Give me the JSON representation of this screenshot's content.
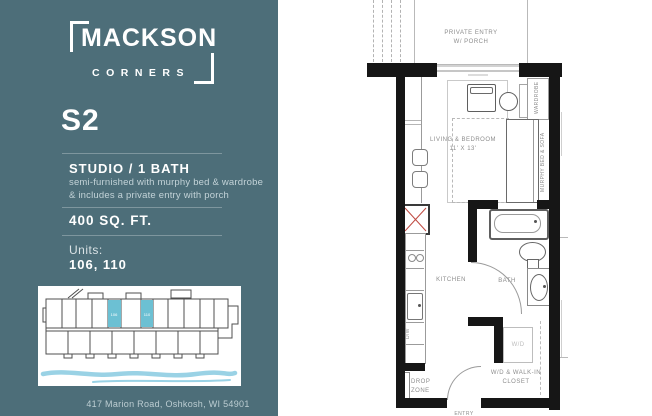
{
  "theme": {
    "panel_background": "#4d6e79",
    "highlight_teal": "#6cc0d3",
    "water_blue": "#9ad2e5",
    "wall_color": "#161616",
    "plan_line_gray": "#9b9b9b",
    "plan_label_gray": "#8d8d8d",
    "fridge_accent_red": "#bf4a42"
  },
  "left_panel": {
    "logo_word": "MACKSON",
    "logo_subword": "CORNERS",
    "plan_code": "S2",
    "unit_type": "STUDIO / 1 BATH",
    "description_line1": "semi-furnished with murphy bed & wardrobe",
    "description_line2": "& includes a private entry with porch",
    "area": "400 SQ. FT.",
    "units_label": "Units:",
    "units_value": "106, 110",
    "address": "417 Marion Road, Oshkosh, WI 54901",
    "sitemap": {
      "unit_a": "106",
      "unit_b": "110"
    }
  },
  "floor_plan": {
    "porch_line1": "PRIVATE ENTRY",
    "porch_line2": "W/ PORCH",
    "living_line1": "LIVING & BEDROOM",
    "living_line2": "11' X 13'",
    "wardrobe": "WARDROBE",
    "murphy_bed": "MURPHY BED & SOFA",
    "kitchen": "KITCHEN",
    "bath": "BATH",
    "dishwasher": "D/W",
    "washer_dryer": "W/D",
    "closet_line1": "W/D & WALK-IN",
    "closet_line2": "CLOSET",
    "dropzone_line1": "DROP",
    "dropzone_line2": "ZONE",
    "entry": "ENTRY"
  }
}
